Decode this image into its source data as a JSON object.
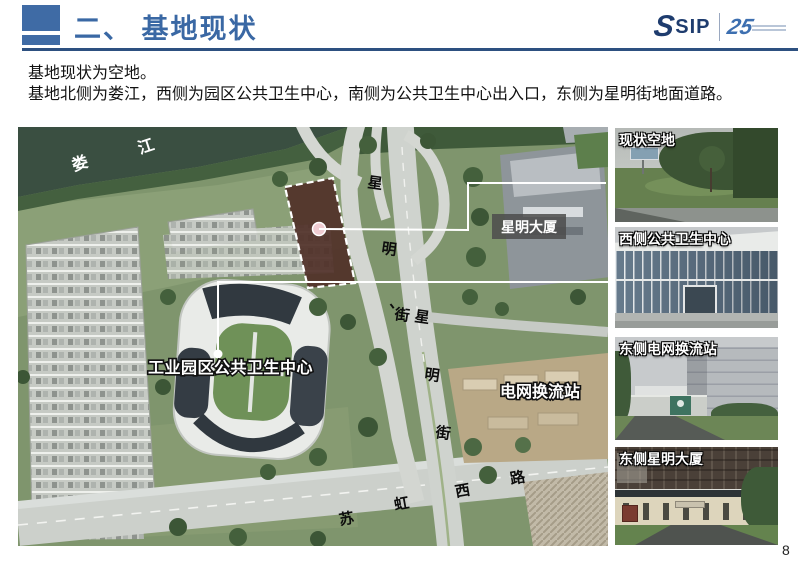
{
  "header": {
    "title": "二、 基地现状",
    "logo_text": "SIP",
    "logo_s": "S",
    "logo_anniversary": "25"
  },
  "intro": {
    "line1": "基地现状为空地。",
    "line2": "基地北侧为娄江，西侧为园区公共卫生中心，南侧为公共卫生中心出入口，东侧为星明街地面道路。"
  },
  "map": {
    "river_chars": [
      "娄",
      "江"
    ],
    "ramp_road_chars": [
      "星",
      "明",
      "、",
      "街"
    ],
    "main_road_chars": [
      "星",
      "明",
      "街"
    ],
    "south_road_chars": [
      "苏",
      "虹",
      "西",
      "路"
    ],
    "labels": {
      "xingming_tower": "星明大厦",
      "health_center": "工业园区公共卫生中心",
      "converter_station": "电网换流站"
    }
  },
  "photos": [
    {
      "caption": "现状空地"
    },
    {
      "caption": "西侧公共卫生中心"
    },
    {
      "caption": "东侧电网换流站"
    },
    {
      "caption": "东侧星明大厦"
    }
  ],
  "page_number": "8",
  "colors": {
    "accent_blue": "#3a68a4",
    "divider_navy": "#2d5080",
    "logo_navy": "#1e3c6e",
    "site_fill": "#503028",
    "annotation_white": "#ffffff"
  }
}
